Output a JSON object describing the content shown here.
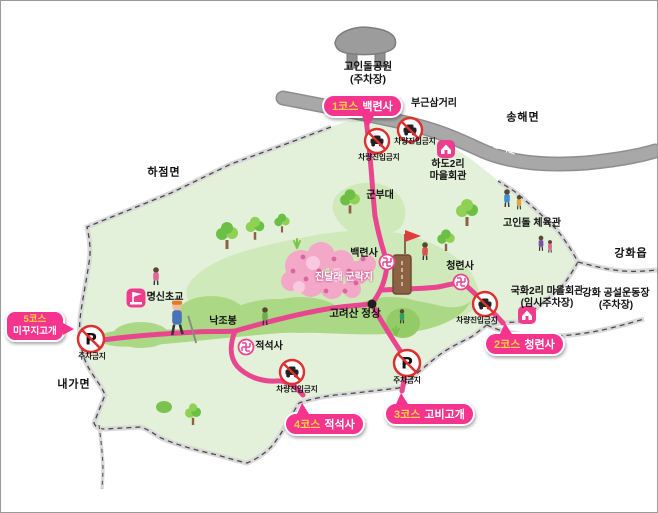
{
  "map_meta": {
    "accent_badge_pink": "#f5348e",
    "accent_trail_pink": "#e8468f",
    "warning_red": "#df2f2f",
    "land_green": "#e4f1da",
    "forest_green": "#cfe9ba",
    "ridge_green": "#abd885"
  },
  "badges": [
    {
      "num": "1코스",
      "name": "백련사"
    },
    {
      "num": "2코스",
      "name": "청련사"
    },
    {
      "num": "3코스",
      "name": "고비고개"
    },
    {
      "num": "4코스",
      "name": "적석사"
    },
    {
      "num": "5코스",
      "name": "미꾸지고개"
    }
  ],
  "regions": {
    "hajeom": "하점면",
    "songhae": "송해면",
    "naega": "내가면",
    "ganghwa_eup": "강화읍"
  },
  "places": {
    "dolmen_park": {
      "line1": "고인돌공원",
      "line2": "(주차장)"
    },
    "bugeun_junction": "부근삼거리",
    "hado_hall": {
      "line1": "하도2리",
      "line2": "마을회관"
    },
    "military_base": "군부대",
    "dolmen_gym": "고인돌 체육관",
    "gukhwa_hall": {
      "line1": "국화2리 마을회관",
      "line2": "(임시주차장)"
    },
    "stadium": {
      "line1": "강화 공설운동장",
      "line2": "(주차장)"
    },
    "baekryeonsa": "백련사",
    "cheongryeonsa": "청련사",
    "jeokseoksa": "적석사",
    "azalea_colony": "진달래 군락지",
    "summit": "고려산 정상",
    "nakjobong": "낙조봉",
    "myeongsin_school": "명신초교",
    "highway": "48번 국도"
  },
  "signs": {
    "no_entry": "차량진입금지",
    "no_parking": "주차금지",
    "parking_letter": "P"
  }
}
